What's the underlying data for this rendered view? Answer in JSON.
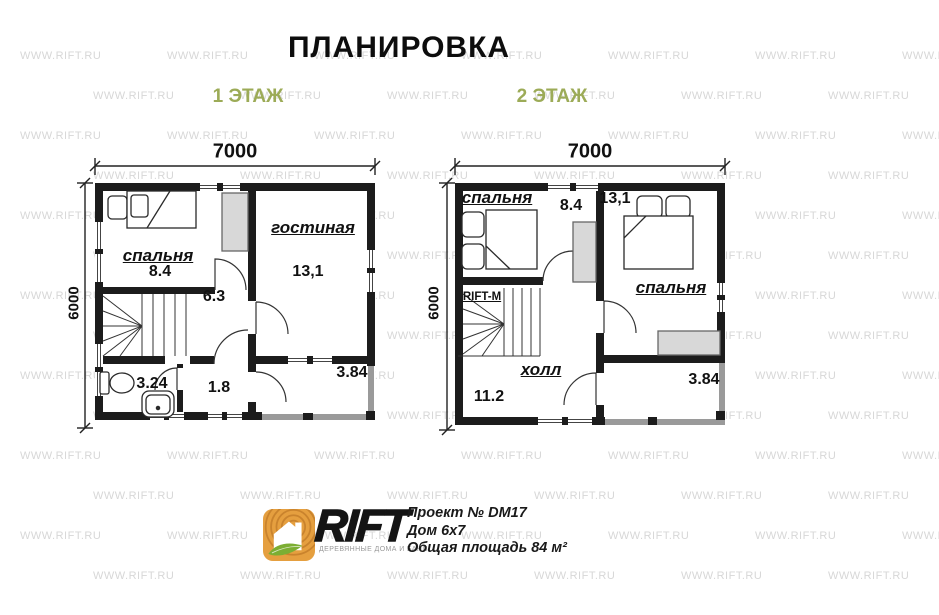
{
  "title": "ПЛАНИРОВКА",
  "watermark": "WWW.RIFT.RU",
  "floor1": {
    "label": "1 ЭТАЖ",
    "width_mm": "7000",
    "height_mm": "6000",
    "rooms": {
      "bedroom": {
        "name": "спальня",
        "area": "8.4"
      },
      "living": {
        "name": "гостиная",
        "area": "13,1"
      },
      "hall": {
        "area": "6.3"
      },
      "bathroom": {
        "area": "3.24"
      },
      "entry": {
        "area": "1.8"
      },
      "terrace": {
        "area": "3.84"
      }
    }
  },
  "floor2": {
    "label": "2 ЭТАЖ",
    "width_mm": "7000",
    "height_mm": "6000",
    "stair_mark": "RIFT-M",
    "rooms": {
      "bedroom_left": {
        "name": "спальня",
        "area": "8.4"
      },
      "bedroom_right": {
        "name": "спальня",
        "area": "13,1"
      },
      "hall": {
        "name": "холл",
        "area": "11.2"
      },
      "balcony": {
        "area": "3.84"
      }
    }
  },
  "footer": {
    "brand": "RIFT",
    "tagline": "ДЕРЕВЯННЫЕ ДОМА И БАНИ",
    "lines": [
      "Проект № DM17",
      "Дом 6х7",
      "Общая площадь 84 м²"
    ]
  },
  "colors": {
    "accent_green": "#9cab57",
    "wall_black": "#1c1c1c",
    "porch_gray": "#9a9a9a",
    "furniture_gray": "#d8d8d8",
    "logo_orange": "#e59f3f",
    "leaf_green": "#7cae33",
    "watermark_gray": "#d7d7d7"
  }
}
